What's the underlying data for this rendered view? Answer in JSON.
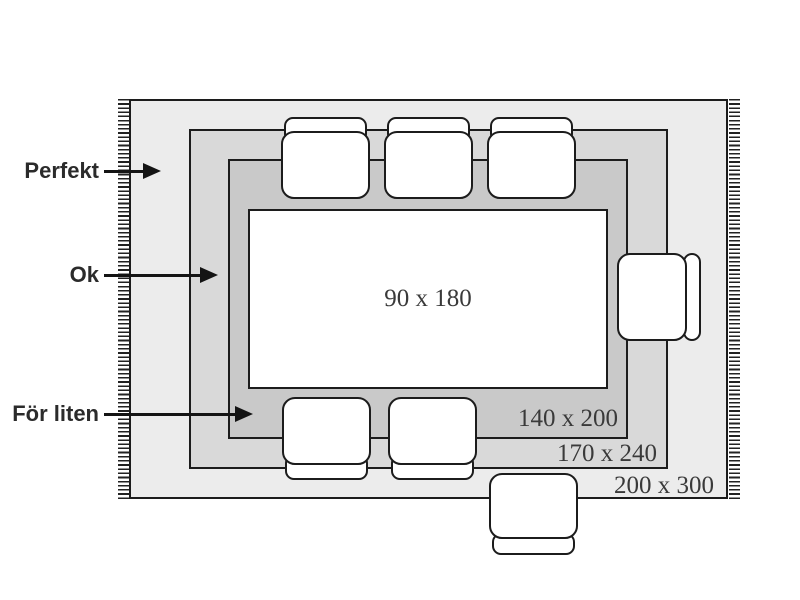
{
  "annotations": {
    "perfekt": "Perfekt",
    "ok": "Ok",
    "for_liten": "För liten"
  },
  "sizes": {
    "table": "90 x 180",
    "rug_inner": "140 x 200",
    "rug_middle": "170 x 240",
    "rug_outer": "200 x 300"
  },
  "colors": {
    "background": "#ffffff",
    "rug_outer": "#ececec",
    "rug_middle": "#d9d9d9",
    "rug_inner": "#c9c9c9",
    "outline": "#1c1c1c",
    "text": "#3a3a3a"
  }
}
